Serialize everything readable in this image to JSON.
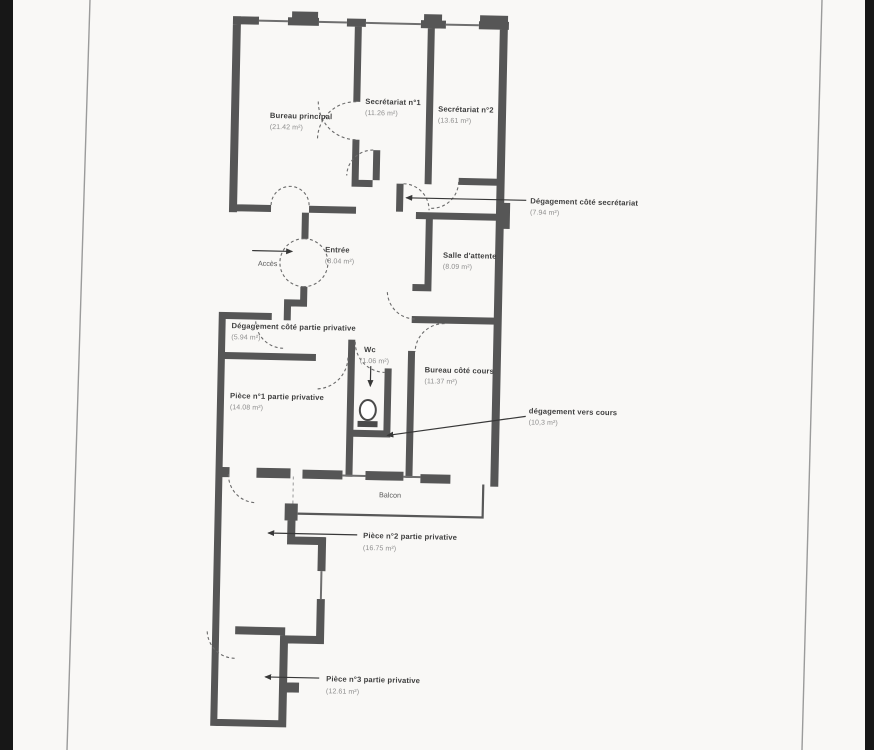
{
  "colors": {
    "wall": "#565656",
    "room_label": "#3e3e3e",
    "area_value": "#8e8e8e",
    "door_arc": "#6b6b6b",
    "scan_edge": "#171717",
    "page_border": "#9b9b9b",
    "paper": "#f9f8f6"
  },
  "plan": {
    "rooms": [
      {
        "id": "bureau-principal",
        "label": "Bureau principal",
        "area": "(21.42 m²)"
      },
      {
        "id": "secretariat-1",
        "label": "Secrétariat n°1",
        "area": "(11.26 m²)"
      },
      {
        "id": "secretariat-2",
        "label": "Secrétariat n°2",
        "area": "(13.61 m²)"
      },
      {
        "id": "degagement-cote-secretariat",
        "label": "Dégagement côté secrétariat",
        "area": "(7.94 m²)"
      },
      {
        "id": "entree",
        "label": "Entrée",
        "area": "(8.04 m²)"
      },
      {
        "id": "salle-attente",
        "label": "Salle d'attente",
        "area": "(8.09 m²)"
      },
      {
        "id": "degagement-cote-partie-privative",
        "label": "Dégagement côté partie privative",
        "area": "(5.94 m²)"
      },
      {
        "id": "wc",
        "label": "Wc",
        "area": "(1.06 m²)"
      },
      {
        "id": "bureau-cote-cours",
        "label": "Bureau côté cours",
        "area": "(11.37 m²)"
      },
      {
        "id": "piece-1",
        "label": "Pièce n°1 partie privative",
        "area": "(14.08 m²)"
      },
      {
        "id": "degagement-vers-cours",
        "label": "dégagement vers cours",
        "area": "(10,3 m²)"
      },
      {
        "id": "piece-2",
        "label": "Pièce n°2 partie privative",
        "area": "(16.75 m²)"
      },
      {
        "id": "piece-3",
        "label": "Pièce n°3 partie privative",
        "area": "(12.61 m²)"
      }
    ],
    "annotations": {
      "acces": "Accès",
      "balcon": "Balcon"
    }
  }
}
